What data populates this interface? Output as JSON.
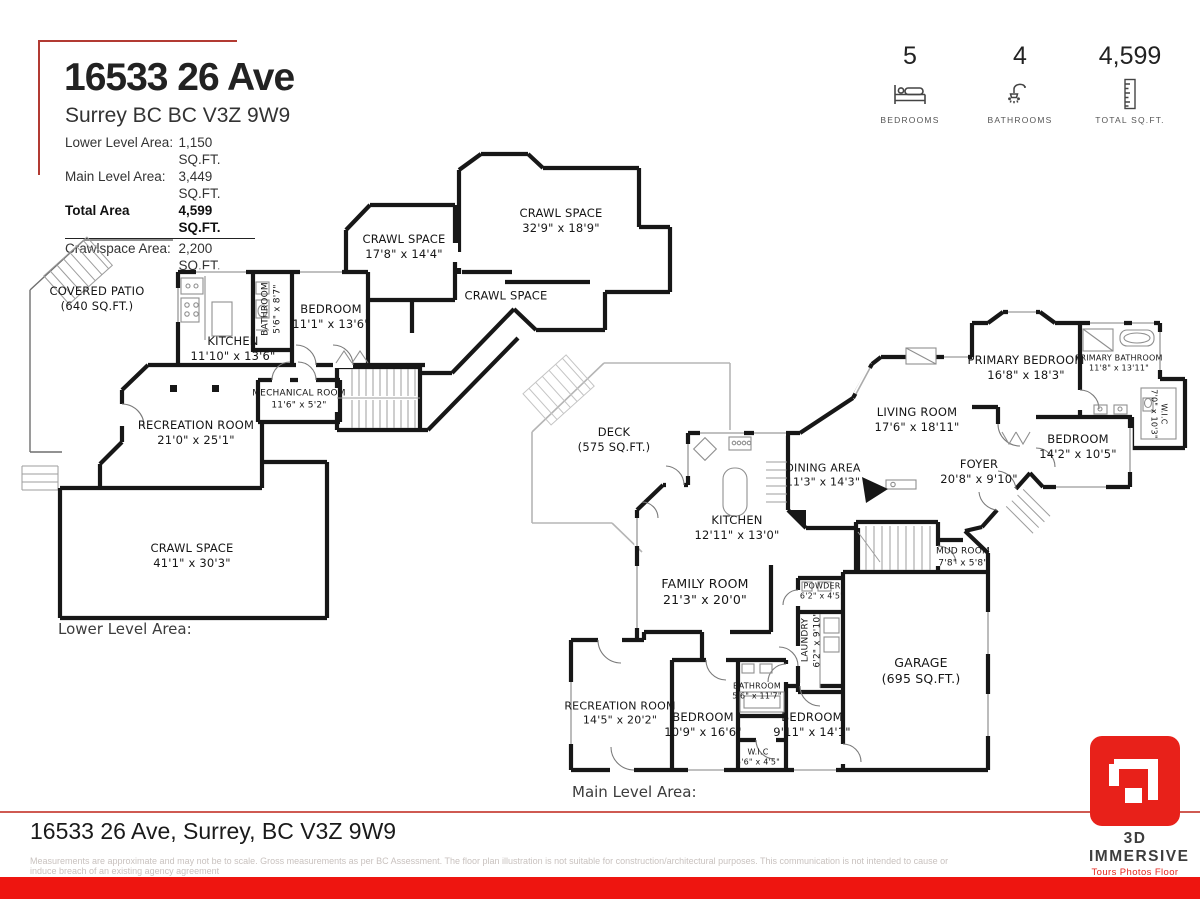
{
  "header": {
    "title": "16533 26 Ave",
    "subtitle": "Surrey BC BC V3Z 9W9",
    "areas": [
      {
        "label": "Lower Level Area:",
        "value": "1,150 SQ.FT."
      },
      {
        "label": "Main Level Area:",
        "value": "3,449 SQ.FT."
      },
      {
        "label": "Total Area",
        "value": "4,599 SQ.FT."
      },
      {
        "label": "Crawlspace Area:",
        "value": "2,200 SQ.FT."
      }
    ]
  },
  "stats": [
    {
      "value": "5",
      "label": "BEDROOMS",
      "icon": "bed-icon"
    },
    {
      "value": "4",
      "label": "BATHROOMS",
      "icon": "shower-icon"
    },
    {
      "value": "4,599",
      "label": "TOTAL SQ.FT.",
      "icon": "ruler-icon"
    }
  ],
  "lower_level": {
    "caption": "Lower Level Area:",
    "rooms": [
      {
        "name": "COVERED PATIO",
        "dims": "(640 SQ.FT.)"
      },
      {
        "name": "KITCHEN",
        "dims": "11'10\" x 13'6\""
      },
      {
        "name": "BATHROOM",
        "dims": "5'6\" x 8'7\""
      },
      {
        "name": "BEDROOM",
        "dims": "11'1\" x 13'6\""
      },
      {
        "name": "CRAWL SPACE",
        "dims": "17'8\" x 14'4\""
      },
      {
        "name": "CRAWL SPACE",
        "dims": "32'9\" x 18'9\""
      },
      {
        "name": "CRAWL SPACE",
        "dims": ""
      },
      {
        "name": "MECHANICAL ROOM",
        "dims": "11'6\" x 5'2\""
      },
      {
        "name": "RECREATION ROOM",
        "dims": "21'0\" x 25'1\""
      },
      {
        "name": "CRAWL SPACE",
        "dims": "41'1\" x 30'3\""
      }
    ]
  },
  "main_level": {
    "caption": "Main Level Area:",
    "rooms": [
      {
        "name": "DECK",
        "dims": "(575 SQ.FT.)"
      },
      {
        "name": "KITCHEN",
        "dims": "12'11\" x 13'0\""
      },
      {
        "name": "DINING AREA",
        "dims": "11'3\" x 14'3\""
      },
      {
        "name": "LIVING ROOM",
        "dims": "17'6\" x 18'11\""
      },
      {
        "name": "PRIMARY BEDROOM",
        "dims": "16'8\" x 18'3\""
      },
      {
        "name": "PRIMARY BATHROOM",
        "dims": "11'8\" x 13'11\""
      },
      {
        "name": "W.I.C",
        "dims": "7'0\" x 10'3\""
      },
      {
        "name": "FOYER",
        "dims": "20'8\" x 9'10\""
      },
      {
        "name": "BEDROOM",
        "dims": "14'2\" x 10'5\""
      },
      {
        "name": "MUD ROOM",
        "dims": "7'8\" x 5'8\""
      },
      {
        "name": "GARAGE",
        "dims": "(695 SQ.FT.)"
      },
      {
        "name": "FAMILY ROOM",
        "dims": "21'3\" x 20'0\""
      },
      {
        "name": "POWDER",
        "dims": "6'2\" x 4'5\""
      },
      {
        "name": "LAUNDRY",
        "dims": "6'2\" x 9'10\""
      },
      {
        "name": "RECREATION ROOM",
        "dims": "14'5\" x 20'2\""
      },
      {
        "name": "BEDROOM",
        "dims": "10'9\" x 16'6\""
      },
      {
        "name": "BATHROOM",
        "dims": "5'6\" x 11'7\""
      },
      {
        "name": "W.I.C",
        "dims": "5'6\" x 4'5\""
      },
      {
        "name": "BEDROOM",
        "dims": "9'11\" x 14'1\""
      }
    ]
  },
  "footer": {
    "address": "16533 26 Ave, Surrey, BC V3Z 9W9",
    "disclaimer": "Measurements are approximate and may not be to scale. Gross measurements as per BC Assessment. The floor plan illustration is not suitable for construction/architectural purposes. This communication is not intended to cause or induce breach of an existing agency agreement",
    "logo_title": "3D IMMERSIVE",
    "logo_subtitle": "Tours  Photos  Floor Plans"
  },
  "colors": {
    "accent_red": "#EE1510",
    "bracket_red": "#B23A32",
    "wall_black": "#171717"
  }
}
